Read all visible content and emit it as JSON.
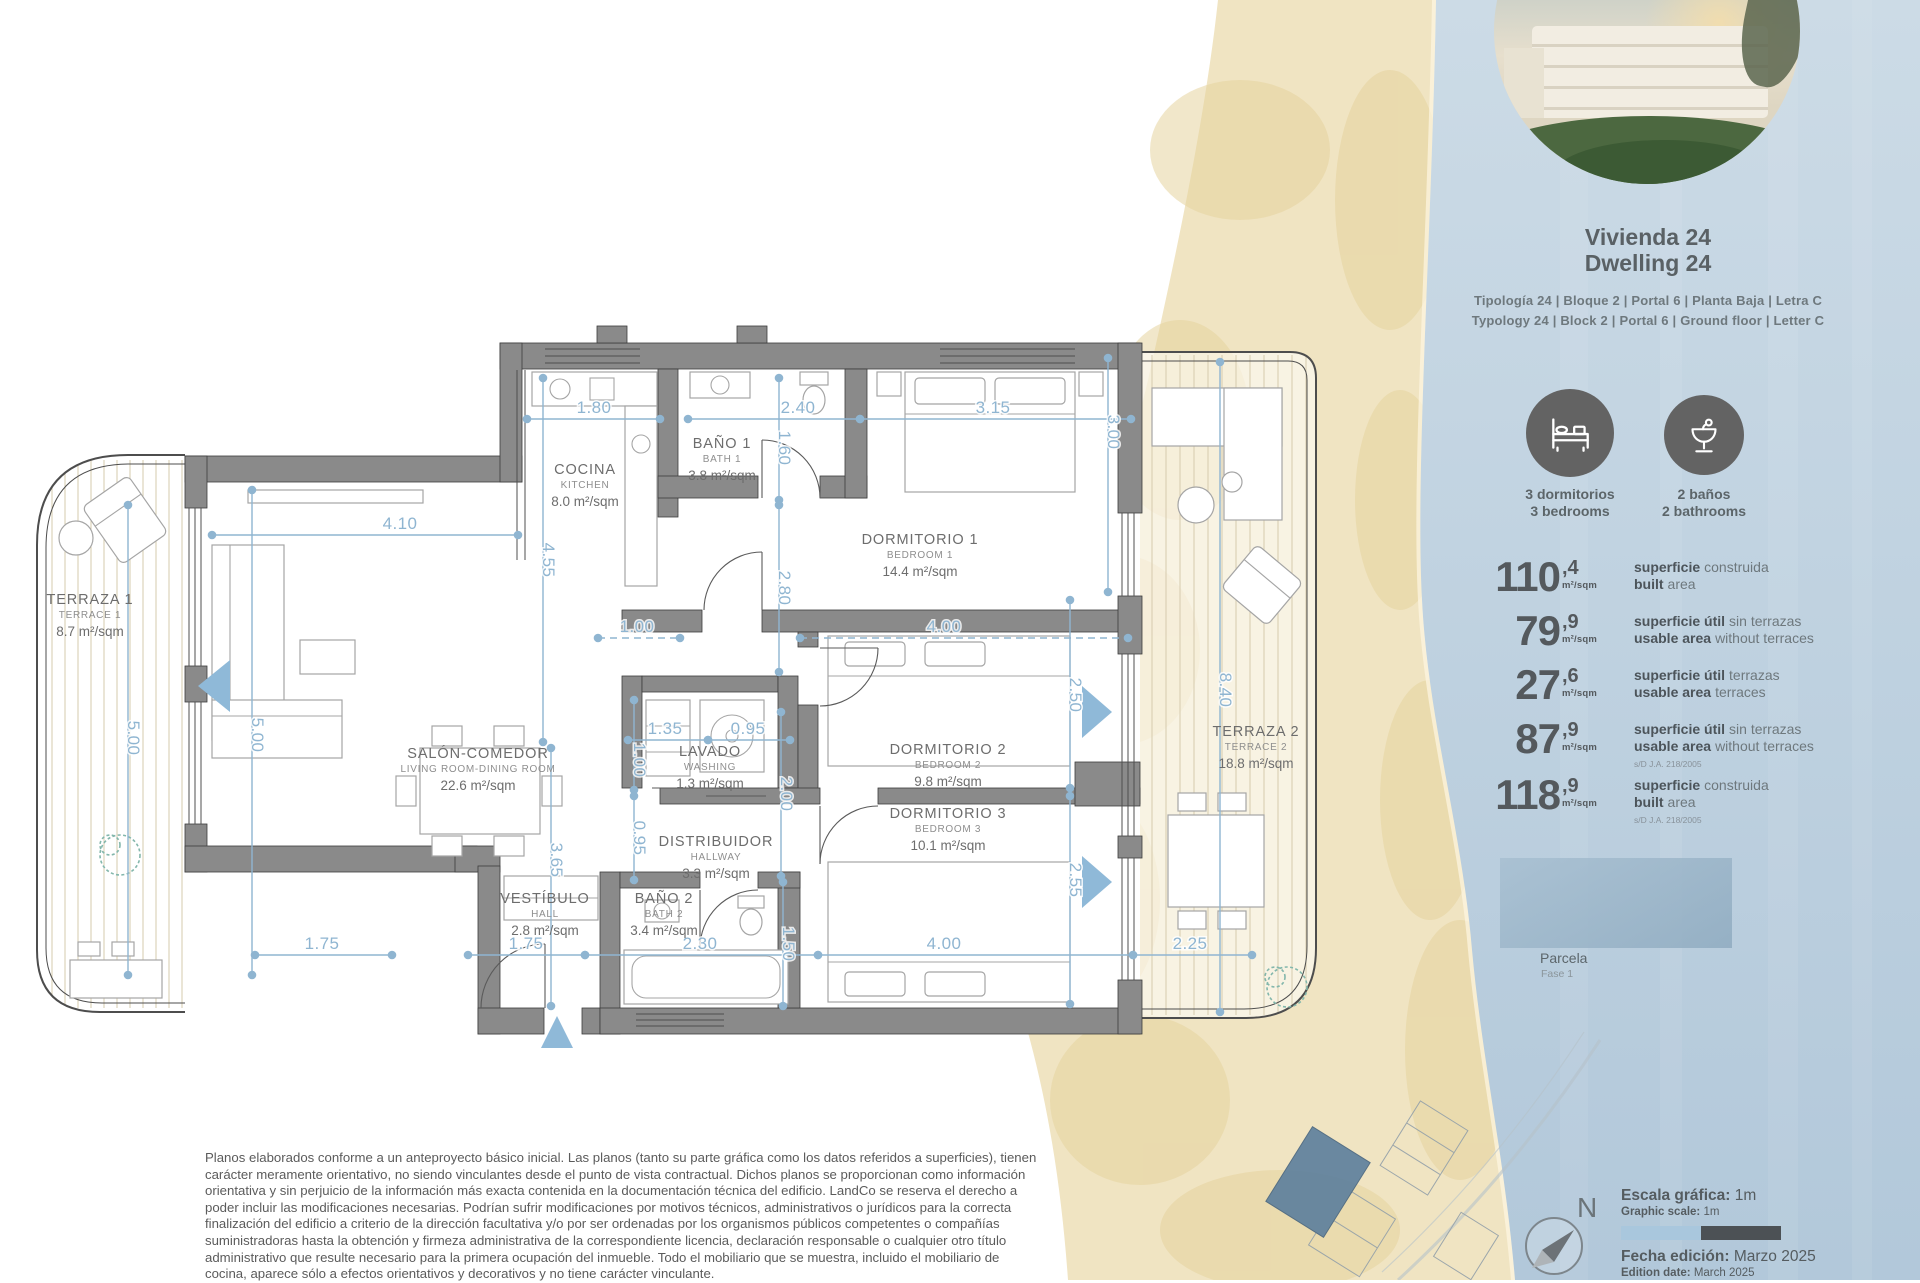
{
  "unit": {
    "title_es": "Vivienda 24",
    "title_en": "Dwelling 24",
    "spec_es": "Tipología 24  |  Bloque 2  |  Portal 6  |  Planta Baja  |  Letra C",
    "spec_en": "Typology 24  |  Block 2  |  Portal 6  |  Ground floor  |  Letter C"
  },
  "features": [
    {
      "icon": "bed-icon",
      "line1": "3 dormitorios",
      "line2": "3 bedrooms"
    },
    {
      "icon": "basin-icon",
      "line1": "2 baños",
      "line2": "2 bathrooms"
    }
  ],
  "areas": [
    {
      "int": "110",
      "dec": ",4",
      "unit": "m²/sqm",
      "es_bold": "superficie",
      "es_rest": "construida",
      "en_bold": "built",
      "en_rest": "area",
      "note": ""
    },
    {
      "int": "79",
      "dec": ",9",
      "unit": "m²/sqm",
      "es_bold": "superficie útil",
      "es_rest": "sin terrazas",
      "en_bold": "usable area",
      "en_rest": "without terraces",
      "note": ""
    },
    {
      "int": "27",
      "dec": ",6",
      "unit": "m²/sqm",
      "es_bold": "superficie útil",
      "es_rest": "terrazas",
      "en_bold": "usable area",
      "en_rest": "terraces",
      "note": ""
    },
    {
      "int": "87",
      "dec": ",9",
      "unit": "m²/sqm",
      "es_bold": "superficie útil",
      "es_rest": "sin terrazas",
      "en_bold": "usable area",
      "en_rest": "without terraces",
      "note": "s/D J.A. 218/2005"
    },
    {
      "int": "118",
      "dec": ",9",
      "unit": "m²/sqm",
      "es_bold": "superficie",
      "es_rest": "construida",
      "en_bold": "built",
      "en_rest": "area",
      "note": "s/D J.A. 218/2005"
    }
  ],
  "parcela": {
    "label": "Parcela",
    "sublabel": "Fase 1"
  },
  "compass": {
    "north": "N"
  },
  "scalebar": {
    "es_bold": "Escala gráfica:",
    "es_val": " 1m",
    "en_bold": "Graphic scale:",
    "en_val": " 1m"
  },
  "edition": {
    "es_bold": "Fecha edición:",
    "es_val": " Marzo 2025",
    "en_bold": "Edition date:",
    "en_val": " March 2025"
  },
  "disclaimer": "Planos elaborados conforme a un anteproyecto básico inicial. Las planos (tanto su parte gráfica como los datos referidos a superficies), tienen carácter meramente orientativo, no siendo vinculantes desde el punto de vista contractual. Dichos planos se proporcionan como información orientativa y sin perjuicio de la información más exacta contenida en la documentación técnica del edificio. LandCo se reserva el derecho a poder incluir las modificaciones necesarias. Podrían sufrir modificaciones por motivos técnicos, administrativos o jurídicos para la correcta finalización del edificio a criterio de la dirección facultativa y/o por ser ordenadas por los organismos públicos competentes o compañías suministradoras hasta la obtención y firmeza administrativa de la correspondiente licencia, declaración responsable o cualquier otro título administrativo que resulte necesario para la primera ocupación del inmueble. Todo el mobiliario que se muestra, incluido el mobiliario de cocina, aparece sólo a efectos orientativos y decorativos y no tiene carácter vinculante.",
  "plan": {
    "rooms": [
      {
        "n": "TERRAZA 1",
        "s": "TERRACE 1",
        "a": "8.7 m²/sqm",
        "x": 90,
        "y": 604
      },
      {
        "n": "SALÓN-COMEDOR",
        "s": "LIVING ROOM-DINING ROOM",
        "a": "22.6 m²/sqm",
        "x": 478,
        "y": 758
      },
      {
        "n": "COCINA",
        "s": "KITCHEN",
        "a": "8.0 m²/sqm",
        "x": 585,
        "y": 474
      },
      {
        "n": "BAÑO 1",
        "s": "BATH 1",
        "a": "3.8 m²/sqm",
        "x": 722,
        "y": 448
      },
      {
        "n": "DORMITORIO 1",
        "s": "BEDROOM 1",
        "a": "14.4 m²/sqm",
        "x": 920,
        "y": 544
      },
      {
        "n": "LAVADO",
        "s": "WASHING",
        "a": "1.3 m²/sqm",
        "x": 710,
        "y": 756
      },
      {
        "n": "DISTRIBUIDOR",
        "s": "HALLWAY",
        "a": "3.3 m²/sqm",
        "x": 716,
        "y": 846
      },
      {
        "n": "VESTÍBULO",
        "s": "HALL",
        "a": "2.8 m²/sqm",
        "x": 545,
        "y": 903
      },
      {
        "n": "BAÑO 2",
        "s": "BATH 2",
        "a": "3.4 m²/sqm",
        "x": 664,
        "y": 903
      },
      {
        "n": "DORMITORIO 2",
        "s": "BEDROOM 2",
        "a": "9.8 m²/sqm",
        "x": 948,
        "y": 754
      },
      {
        "n": "DORMITORIO 3",
        "s": "BEDROOM 3",
        "a": "10.1 m²/sqm",
        "x": 948,
        "y": 818
      },
      {
        "n": "TERRAZA 2",
        "s": "TERRACE 2",
        "a": "18.8 m²/sqm",
        "x": 1256,
        "y": 736
      }
    ],
    "dims": [
      {
        "v": "1.80",
        "x1": 527,
        "y1": 419,
        "x2": 660,
        "y2": 419,
        "lx": 594,
        "ly": 413
      },
      {
        "v": "2.40",
        "x1": 688,
        "y1": 419,
        "x2": 860,
        "y2": 419,
        "lx": 798,
        "ly": 413
      },
      {
        "v": "3.15",
        "x1": 860,
        "y1": 419,
        "x2": 1131,
        "y2": 419,
        "lx": 993,
        "ly": 413
      },
      {
        "v": "4.10",
        "x1": 212,
        "y1": 535,
        "x2": 518,
        "y2": 535,
        "lx": 400,
        "ly": 529
      },
      {
        "v": "1.00",
        "x1": 598,
        "y1": 638,
        "x2": 680,
        "y2": 638,
        "lx": 637,
        "ly": 632,
        "d": 1
      },
      {
        "v": "4.00",
        "x1": 800,
        "y1": 638,
        "x2": 1128,
        "y2": 638,
        "lx": 944,
        "ly": 632,
        "d": 1
      },
      {
        "v": "1.35",
        "x1": 628,
        "y1": 740,
        "x2": 708,
        "y2": 740,
        "lx": 665,
        "ly": 734
      },
      {
        "v": "0.95",
        "x1": 708,
        "y1": 740,
        "x2": 790,
        "y2": 740,
        "lx": 748,
        "ly": 734
      },
      {
        "v": "1.75",
        "x1": 255,
        "y1": 955,
        "x2": 392,
        "y2": 955,
        "lx": 322,
        "ly": 949
      },
      {
        "v": "1.75",
        "x1": 468,
        "y1": 955,
        "x2": 585,
        "y2": 955,
        "lx": 526,
        "ly": 949
      },
      {
        "v": "2.30",
        "x1": 585,
        "y1": 955,
        "x2": 818,
        "y2": 955,
        "lx": 700,
        "ly": 949
      },
      {
        "v": "4.00",
        "x1": 818,
        "y1": 955,
        "x2": 1133,
        "y2": 955,
        "lx": 944,
        "ly": 949
      },
      {
        "v": "2.25",
        "x1": 1133,
        "y1": 955,
        "x2": 1252,
        "y2": 955,
        "lx": 1190,
        "ly": 949
      },
      {
        "v": "4.55",
        "x1": 543,
        "y1": 378,
        "x2": 543,
        "y2": 742,
        "lx": 543,
        "ly": 560,
        "rot": 1
      },
      {
        "v": "5.00",
        "x1": 128,
        "y1": 505,
        "x2": 128,
        "y2": 975,
        "lx": 128,
        "ly": 738,
        "rot": 1
      },
      {
        "v": "5.00",
        "x1": 252,
        "y1": 490,
        "x2": 252,
        "y2": 975,
        "lx": 252,
        "ly": 735,
        "rot": 1
      },
      {
        "v": "1.60",
        "x1": 779,
        "y1": 378,
        "x2": 779,
        "y2": 500,
        "lx": 779,
        "ly": 448,
        "rot": 1
      },
      {
        "v": "2.80",
        "x1": 779,
        "y1": 505,
        "x2": 779,
        "y2": 672,
        "lx": 779,
        "ly": 588,
        "rot": 1
      },
      {
        "v": "3.00",
        "x1": 1108,
        "y1": 358,
        "x2": 1108,
        "y2": 592,
        "lx": 1108,
        "ly": 432,
        "rot": 1
      },
      {
        "v": "2.50",
        "x1": 1070,
        "y1": 600,
        "x2": 1070,
        "y2": 788,
        "lx": 1070,
        "ly": 695,
        "rot": 1
      },
      {
        "v": "2.55",
        "x1": 1070,
        "y1": 796,
        "x2": 1070,
        "y2": 1004,
        "lx": 1070,
        "ly": 880,
        "rot": 1
      },
      {
        "v": "2.00",
        "x1": 781,
        "y1": 712,
        "x2": 781,
        "y2": 876,
        "lx": 781,
        "ly": 794,
        "rot": 1
      },
      {
        "v": "1.00",
        "x1": 634,
        "y1": 700,
        "x2": 634,
        "y2": 790,
        "lx": 634,
        "ly": 760,
        "rot": 1
      },
      {
        "v": "0.95",
        "x1": 634,
        "y1": 796,
        "x2": 634,
        "y2": 880,
        "lx": 634,
        "ly": 838,
        "rot": 1
      },
      {
        "v": "3.65",
        "x1": 551,
        "y1": 748,
        "x2": 551,
        "y2": 1006,
        "lx": 551,
        "ly": 860,
        "rot": 1
      },
      {
        "v": "1.50",
        "x1": 783,
        "y1": 882,
        "x2": 783,
        "y2": 1006,
        "lx": 783,
        "ly": 944,
        "rot": 1
      },
      {
        "v": "8.40",
        "x1": 1220,
        "y1": 362,
        "x2": 1220,
        "y2": 1012,
        "lx": 1220,
        "ly": 690,
        "rot": 1
      }
    ]
  }
}
